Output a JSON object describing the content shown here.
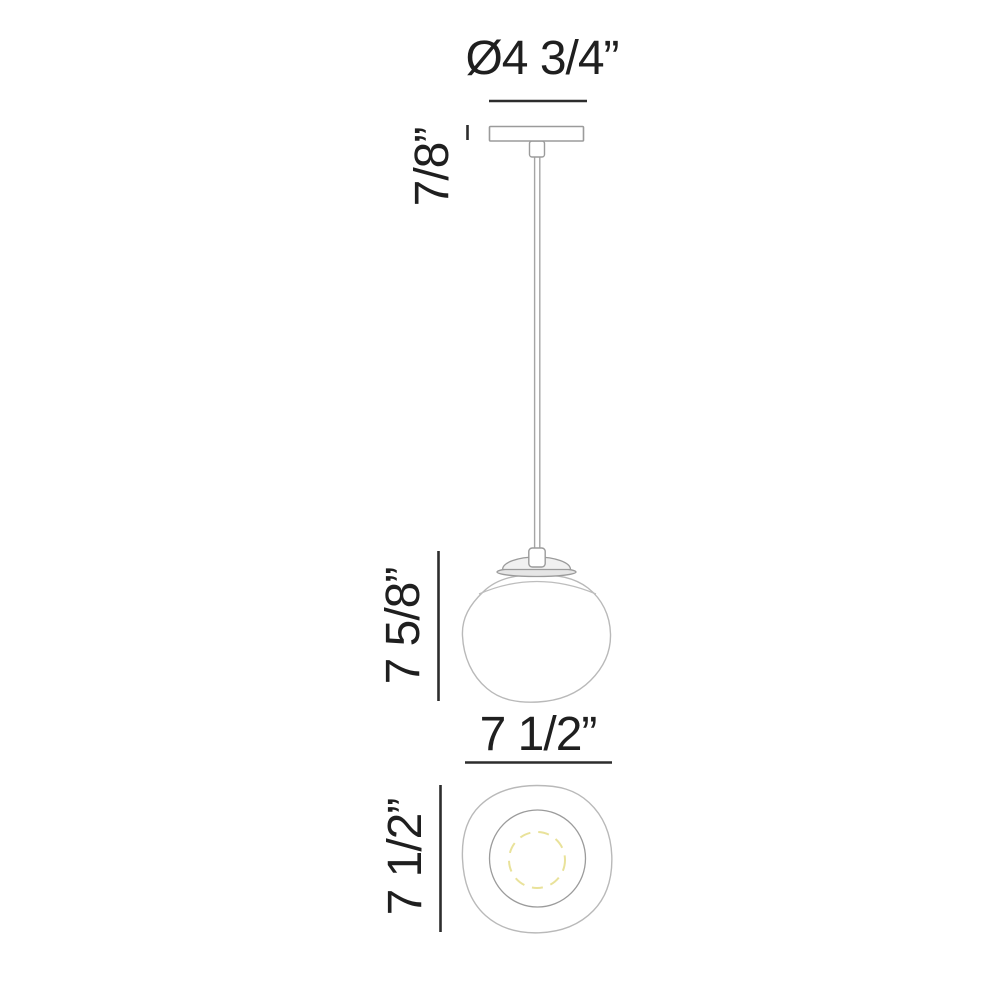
{
  "diagram": {
    "type": "technical-dimension-drawing",
    "subject": "single globe pendant light fixture — front elevation and bottom view",
    "labels": {
      "canopy_diameter": "Ø4 3/4”",
      "canopy_height": "7/8”",
      "fixture_height": "7 5/8”",
      "shade_width": "7 1/2”",
      "shade_depth": "7 1/2”"
    },
    "colors": {
      "background": "#ffffff",
      "dimension_ink": "#2d2d2d",
      "text_ink": "#1f1f1f",
      "fixture_line": "#9b9b9b",
      "glass_line": "#b9b9b9",
      "lamp_dashed_yellow": "#e9e29a",
      "cap_fill": "#f1f1f1",
      "cap_rim_fill": "#e6e6e6"
    }
  }
}
